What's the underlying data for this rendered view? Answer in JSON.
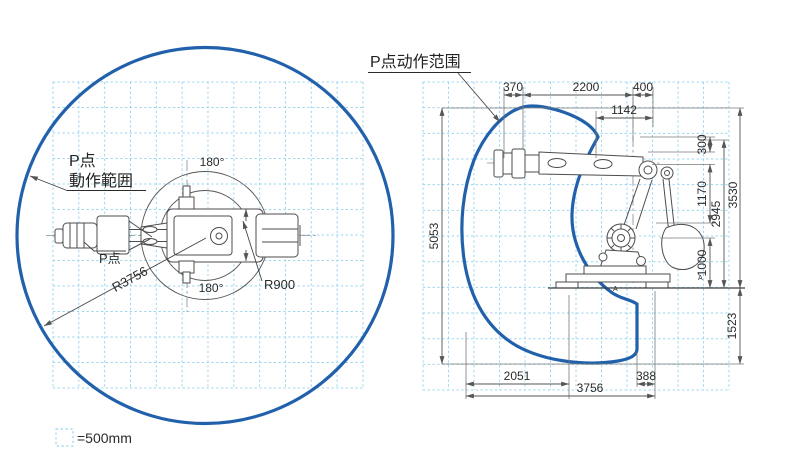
{
  "colors": {
    "envelope_blue": "#2160ab",
    "grid_blue": "#96d5f0",
    "robot_line_gray": "#4d4d4d",
    "dimension_gray": "#555555"
  },
  "legend": {
    "scale_label": "=500mm"
  },
  "left_view": {
    "annotation_line1": "P点",
    "annotation_line2": "動作範囲",
    "p_point_label": "P点",
    "angle_top_label": "180°",
    "angle_bottom_label": "180°",
    "radius_envelope_label": "R3756",
    "radius_inner_label": "R900"
  },
  "right_view": {
    "title": "P点动作范围",
    "top_dims": [
      "370",
      "2200",
      "400"
    ],
    "offset_dim": "1142",
    "total_height_dim": "5053",
    "right_dims": {
      "d300": "300",
      "d1170": "1170",
      "d2945": "2945",
      "d3530": "3530",
      "d1000": "1000",
      "d1523": "1523"
    },
    "bottom_dims": {
      "d2051": "2051",
      "d3756": "3756",
      "d388": "388"
    },
    "section_mark": "A"
  }
}
